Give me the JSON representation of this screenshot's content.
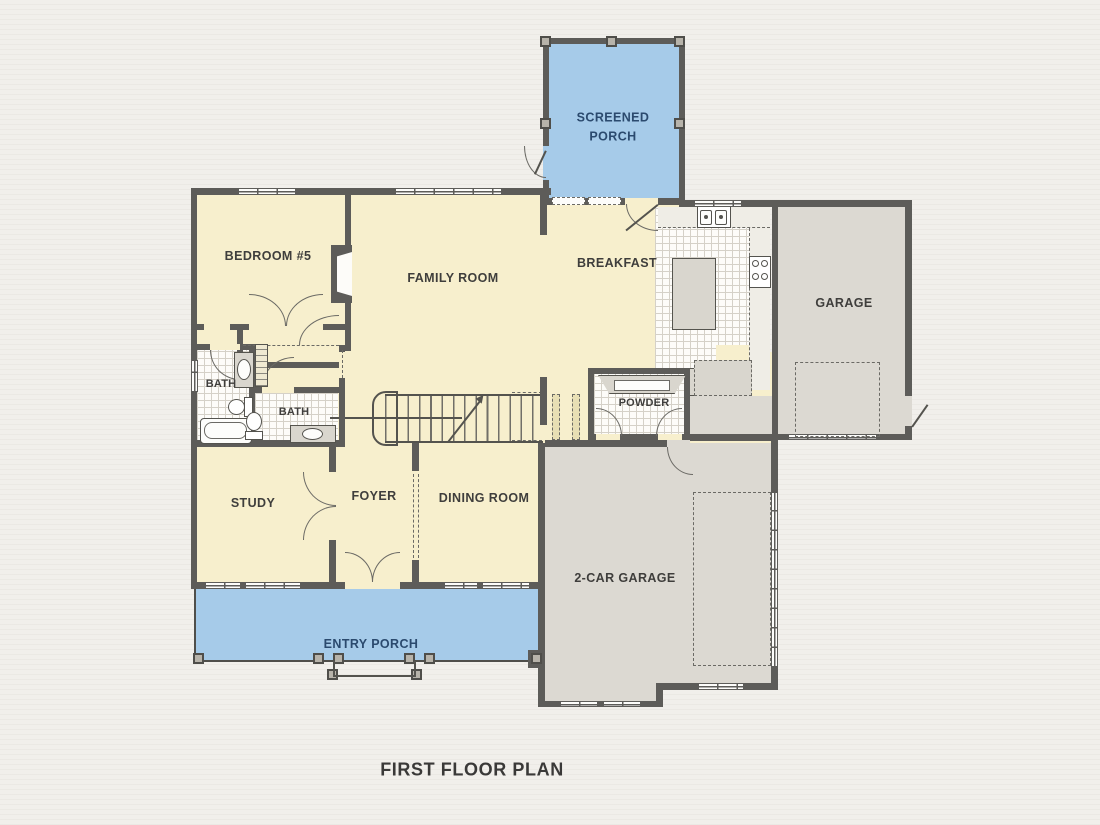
{
  "title": "FIRST FLOOR PLAN",
  "rooms": {
    "screened_porch": "SCREENED PORCH",
    "bedroom5": "BEDROOM #5",
    "family_room": "FAMILY ROOM",
    "breakfast": "BREAKFAST",
    "garage": "GARAGE",
    "bath_upper": "BATH",
    "bath_lower": "BATH",
    "powder": "POWDER",
    "study": "STUDY",
    "foyer": "FOYER",
    "dining_room": "DINING ROOM",
    "two_car_garage": "2-CAR GARAGE",
    "entry_porch": "ENTRY PORCH"
  },
  "colors": {
    "background": "#f1efeb",
    "room_cream": "#f7efcd",
    "porch_blue": "#a6cbe9",
    "garage_gray": "#dcd9d2",
    "wall": "#5d5c59",
    "tile_white": "#fdfcf9",
    "label_dark": "#3f3e3c",
    "label_navy": "#2b4a6e"
  }
}
